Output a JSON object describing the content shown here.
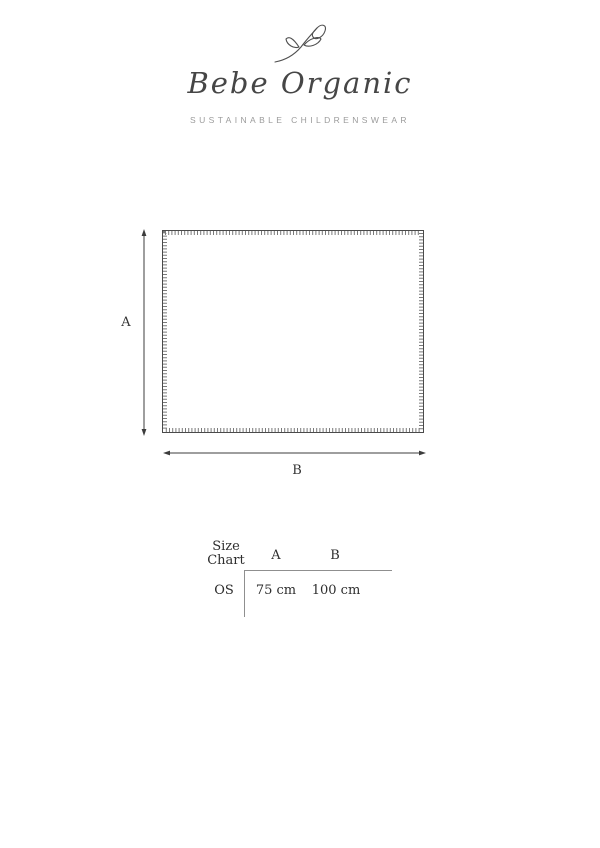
{
  "brand": {
    "logo_icon": "branch-sketch",
    "name": "Bebe Organic",
    "tagline": "SUSTAINABLE CHILDRENSWEAR"
  },
  "diagram": {
    "type": "blanket-outline-with-dimension-arrows",
    "height_label": "A",
    "width_label": "B"
  },
  "size_chart": {
    "title": "Size Chart",
    "columns": [
      "A",
      "B"
    ],
    "rows": [
      {
        "size": "OS",
        "values": [
          "75 cm",
          "100 cm"
        ]
      }
    ]
  },
  "colors": {
    "ink": "#3c3c3c",
    "muted_gray": "#9b9b9b",
    "line_gray": "#8f8f8f",
    "background": "#ffffff"
  }
}
